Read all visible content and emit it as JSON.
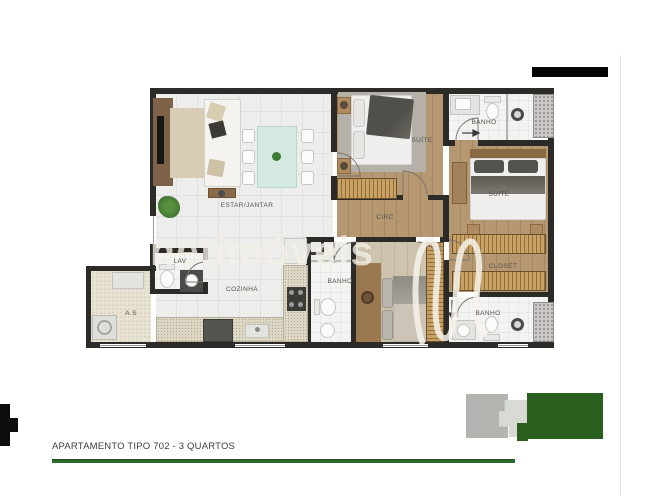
{
  "image_type": "apartment-floor-plan-listing",
  "floor_plan": {
    "watermark": {
      "text": "netimóveis"
    },
    "rooms": [
      {
        "id": "estar-jantar",
        "label": "ESTAR/JANTAR"
      },
      {
        "id": "suite-1",
        "label": "SUÍTE"
      },
      {
        "id": "banho-1",
        "label": "BANHO"
      },
      {
        "id": "suite-2",
        "label": "SUÍTE"
      },
      {
        "id": "circ",
        "label": "CIRC"
      },
      {
        "id": "closet",
        "label": "CLOSET"
      },
      {
        "id": "banho-2",
        "label": "BANHO"
      },
      {
        "id": "banho-3",
        "label": "BANHO"
      },
      {
        "id": "lav",
        "label": "LAV"
      },
      {
        "id": "cozinha",
        "label": "COZINHA"
      },
      {
        "id": "area-servico",
        "label": "A.S"
      }
    ],
    "colors": {
      "wall": "#2d2b27",
      "wood_floor": "#b59872",
      "tile_floor": "#ededeb",
      "bath_floor": "#f3f3f1",
      "wardrobe": "#c8a264",
      "dining_table": "#d3e9e2"
    }
  },
  "footer": {
    "title": "APARTAMENTO TIPO 702 - 3 QUARTOS",
    "line_color": "#2e6b2e"
  },
  "decorations": {
    "top_bar_color": "#050505",
    "logo_gray": "#b4b4b1",
    "logo_light_gray": "#d8dbd4",
    "logo_green": "#2a5e1f",
    "cross_color": "#0d0d0d"
  }
}
